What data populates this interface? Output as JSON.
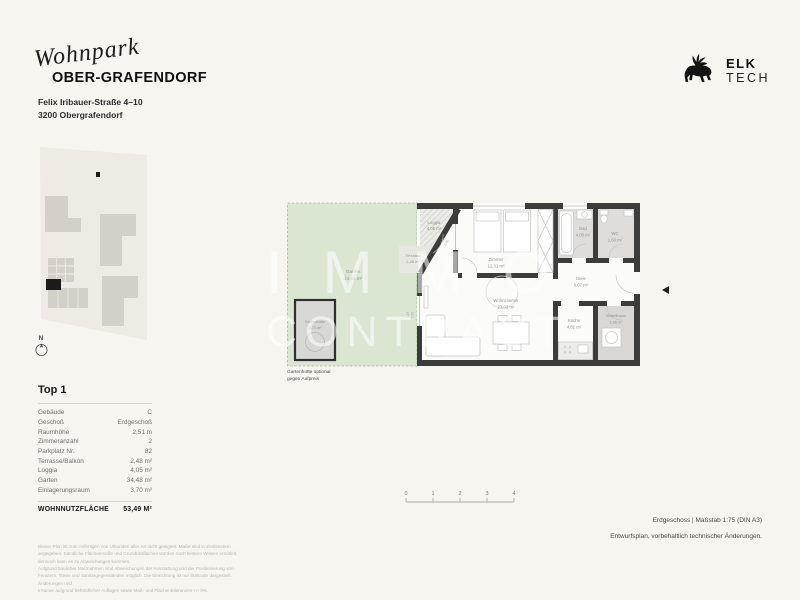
{
  "header": {
    "project_script": "Wohnpark",
    "project_name": "OBER-GRAFENDORF",
    "address_line1": "Felix Iribauer-Straße 4–10",
    "address_line2": "3200 Obergrafendorf"
  },
  "brand": {
    "name_top": "ELK",
    "name_bottom": "TECH",
    "icon": "elk-silhouette"
  },
  "site_plan": {
    "north_label": "N"
  },
  "watermark": {
    "line1": "IMMO",
    "line2": "CONTRACT"
  },
  "floor_plan": {
    "rooms": [
      {
        "name": "Loggia",
        "area": "4,05 m²"
      },
      {
        "name": "Terrasse",
        "area": "2,48 m²"
      },
      {
        "name": "Garten",
        "area": "34,48 m²"
      },
      {
        "name": "Gartenhütte",
        "area": "3,70 m²"
      },
      {
        "name": "Zimmer",
        "area": "12,31 m²"
      },
      {
        "name": "Wohnzimmer",
        "area": "23,03 m²"
      },
      {
        "name": "Bad",
        "area": "4,00 m²"
      },
      {
        "name": "WC",
        "area": "1,60 m²"
      },
      {
        "name": "Diele",
        "area": "6,07 m²"
      },
      {
        "name": "Küche",
        "area": "4,82 m²"
      },
      {
        "name": "Abstellraum",
        "area": "1,66 m²"
      }
    ],
    "dimension_annotations": [
      {
        "width": "1,75",
        "height": "2,30"
      },
      {
        "width": "1,13",
        "height": "2,30"
      }
    ],
    "shed_note_line1": "Gartenhütte optional",
    "shed_note_line2": "gegen Aufpreis"
  },
  "unit_table": {
    "title": "Top 1",
    "rows": [
      {
        "label": "Gebäude",
        "value": "C"
      },
      {
        "label": "Geschoß",
        "value": "Erdgeschoß"
      },
      {
        "label": "Raumhöhe",
        "value": "2,51 m"
      },
      {
        "label": "Zimmeranzahl",
        "value": "2"
      },
      {
        "label": "Parkplatz Nr.",
        "value": "82"
      },
      {
        "label": "Terrasse/Balkon",
        "value": "2,48 m²"
      },
      {
        "label": "Loggia",
        "value": "4,05 m²"
      },
      {
        "label": "Garten",
        "value": "34,48 m²"
      },
      {
        "label": "Einlagerungsraum",
        "value": "3,70 m²"
      }
    ],
    "total_label": "WOHNNUTZFLÄCHE",
    "total_value": "53,49 M²"
  },
  "scale_bar": {
    "ticks": [
      "0",
      "1",
      "2",
      "3",
      "4"
    ]
  },
  "footer": {
    "plan_info": "Erdgeschoss | Maßstab 1:75 (DIN A3)",
    "revision_note": "Entwurfsplan, vorbehaltlich technischer Änderungen.",
    "legal_lines": [
      "Dieser Plan ist zum Anfertigen von Urkunden aller Art nicht geeignet. Maße sind in Zentimetern angegeben. Sämtliche Flächenmaße und Grundrissflächen wurden nach bestem Wissen ermittelt, dennoch kann es zu Abweichungen kommen.",
      "Aufgrund baulicher Maßnahmen sind Abweichungen der Ausstattung und der Positionierung von Fenstern, Türen und Sanitärgegenständen möglich. Die Einrichtung ist nur illustrativ dargestellt. Änderungen und",
      "Irrtümer aufgrund behördlicher Auflagen sowie Maß- und Flächentoleranzen +/- 3%."
    ]
  },
  "colors": {
    "page_background": "#f7f5f0",
    "garden_green": "#dae5d2",
    "wall_dark": "#3c3c3c",
    "highlight_black": "#1b1b1b"
  }
}
